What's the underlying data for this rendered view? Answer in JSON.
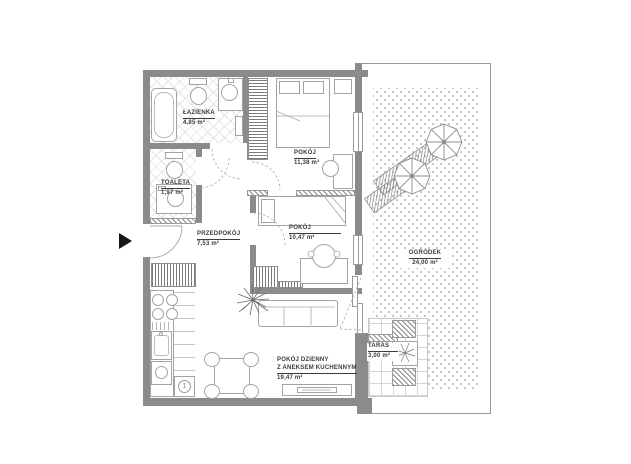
{
  "rooms": {
    "lazienka": {
      "name": "ŁAZIENKA",
      "area": "4,85 m²"
    },
    "toaleta": {
      "name": "TOALETA",
      "area": "1,97 m²"
    },
    "przedpokoj": {
      "name": "PRZEDPOKÓJ",
      "area": "7,53 m²"
    },
    "pokoj_a": {
      "name": "POKÓJ",
      "area": "11,38 m²"
    },
    "pokoj_b": {
      "name": "POKÓJ",
      "area": "10,47 m²"
    },
    "salon": {
      "name_line1": "POKÓJ DZIENNY",
      "name_line2": "Z ANEKSEM KUCHENNYM",
      "area": "19,47 m²"
    },
    "taras": {
      "name": "TARAS",
      "area": "3,00 m²"
    },
    "ogrodek": {
      "name": "OGRÓDEK",
      "area": "24,00 m²"
    }
  },
  "kitchen": {
    "unit_marker": "1"
  },
  "colors": {
    "wall": "#8b8b8b",
    "line": "#9a9a9a",
    "text": "#3b3b3b",
    "background": "#ffffff",
    "arrow": "#161616"
  }
}
